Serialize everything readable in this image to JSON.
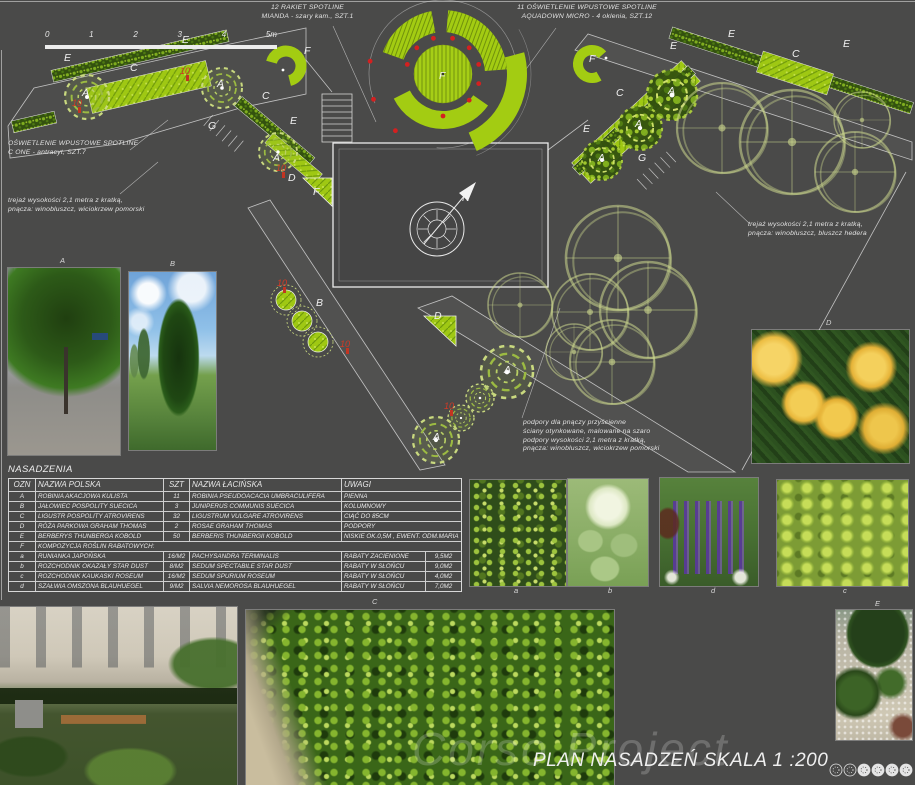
{
  "title_block": {
    "title": "PLAN NASADZEŃ  SKALA 1 :200",
    "watermark": "Corso Project"
  },
  "scale_bar": {
    "ticks": [
      "0",
      "1",
      "2",
      "3",
      "4",
      "5m"
    ]
  },
  "annotations": {
    "spotline_mianda": "12  RAKIET SPOTLINE\nMIANDA - szary kam., SZT.1",
    "aquadown": "11  OŚWIETLENIE WPUSTOWE SPOTLINE\nAQUADOWN MICRO - 4 oklenia, SZT.12",
    "cone": "OŚWIETLENIE WPUSTOWE SPOTLINE\nC ONE - antracyt, SZT.7",
    "trellis_left": "trejaż wysokości 2,1 metra z kratką,\npnącza: winobluszcz, wiciokrzew pomorski",
    "trellis_right": "trejaż wysokości 2,1 metra z kratką,\npnącza: winobluszcz, bluszcz hedera",
    "supports": "podpory dla pnączy przyścienne\nściany otynkowane, malowane na szaro\npodpory wysokości 2,1 metra z kratką,\npnącza: winobluszcz, wiciokrzew pomorski"
  },
  "plan": {
    "north_label": "N",
    "labels": [
      {
        "t": "E",
        "x": 64,
        "y": 61
      },
      {
        "t": "E",
        "x": 182,
        "y": 43
      },
      {
        "t": "C",
        "x": 130,
        "y": 71
      },
      {
        "t": "A",
        "x": 82,
        "y": 96
      },
      {
        "t": "A",
        "x": 217,
        "y": 87
      },
      {
        "t": "G",
        "x": 208,
        "y": 129
      },
      {
        "t": "C",
        "x": 262,
        "y": 99
      },
      {
        "t": "E",
        "x": 290,
        "y": 124
      },
      {
        "t": "A",
        "x": 273,
        "y": 161
      },
      {
        "t": "D",
        "x": 288,
        "y": 181
      },
      {
        "t": "F",
        "x": 313,
        "y": 195
      },
      {
        "t": "F",
        "x": 304,
        "y": 54
      },
      {
        "t": "F",
        "x": 439,
        "y": 79
      },
      {
        "t": "F",
        "x": 589,
        "y": 62
      },
      {
        "t": "E",
        "x": 670,
        "y": 49
      },
      {
        "t": "E",
        "x": 728,
        "y": 37
      },
      {
        "t": "C",
        "x": 792,
        "y": 57
      },
      {
        "t": "E",
        "x": 843,
        "y": 47
      },
      {
        "t": "C",
        "x": 616,
        "y": 96
      },
      {
        "t": "A",
        "x": 668,
        "y": 94
      },
      {
        "t": "A",
        "x": 635,
        "y": 127
      },
      {
        "t": "E",
        "x": 583,
        "y": 132
      },
      {
        "t": "A",
        "x": 598,
        "y": 161
      },
      {
        "t": "G",
        "x": 638,
        "y": 161
      },
      {
        "t": "B",
        "x": 316,
        "y": 306
      },
      {
        "t": "D",
        "x": 434,
        "y": 319
      },
      {
        "t": "A",
        "x": 504,
        "y": 373
      },
      {
        "t": "A",
        "x": 433,
        "y": 440
      },
      {
        "t": "N",
        "x": 462,
        "y": 201
      }
    ],
    "red_labels": [
      {
        "t": "10",
        "x": 72,
        "y": 106
      },
      {
        "t": "10",
        "x": 180,
        "y": 74
      },
      {
        "t": "10",
        "x": 276,
        "y": 171
      },
      {
        "t": "10",
        "x": 277,
        "y": 286
      },
      {
        "t": "10",
        "x": 340,
        "y": 347
      },
      {
        "t": "10",
        "x": 444,
        "y": 409
      }
    ]
  },
  "table": {
    "title": "NASADZENIA",
    "headers": [
      "OZN",
      "NAZWA POLSKA",
      "SZT",
      "NAZWA ŁACIŃSKA",
      "UWAGI"
    ],
    "rows": [
      {
        "ozn": "A",
        "polska": "ROBINIA AKACJOWA KULISTA",
        "szt": "11",
        "lacinska": "ROBINIA PSEUDOACACIA UMBRACULIFERA",
        "uwagi": "PIENNA",
        "area": null
      },
      {
        "ozn": "B",
        "polska": "JAŁOWIEC POSPOLITY SUECICA",
        "szt": "3",
        "lacinska": "JUNIPERUS COMMUNIS SUECICA",
        "uwagi": "KOLUMNOWY",
        "area": null
      },
      {
        "ozn": "C",
        "polska": "LIGUSTR POSPOLITY ATROVIRENS",
        "szt": "32",
        "lacinska": "LIGUSTRUM VULGARE ATROVIRENS",
        "uwagi": "CIĄĆ DO 85CM",
        "area": null
      },
      {
        "ozn": "D",
        "polska": "RÓŻA PARKOWA GRAHAM THOMAS",
        "szt": "2",
        "lacinska": "ROSAE GRAHAM THOMAS",
        "uwagi": "PODPORY",
        "area": null
      },
      {
        "ozn": "E",
        "polska": "BERBERYS THUNBERGA KOBOLD",
        "szt": "50",
        "lacinska": "BERBERIS THUNBERGII KOBOLD",
        "uwagi": "NISKIE OK.0,5M , EWENT. ODM.MARIA",
        "area": null
      },
      {
        "ozn": "F",
        "polska": "KOMPOZYCJA ROŚLIN RABATOWYCH:",
        "szt": "",
        "lacinska": "",
        "uwagi": "",
        "area": null,
        "span": true
      },
      {
        "ozn": "a",
        "polska": "RUNIANKA JAPOŃSKA",
        "szt": "16/M2",
        "lacinska": "PACHYSANDRA TERMINALIS",
        "uwagi": "RABATY ZACIENIONE",
        "area": "9,5M2"
      },
      {
        "ozn": "b",
        "polska": "ROZCHODNIK OKAZAŁY STAR DUST",
        "szt": "8/M2",
        "lacinska": "SEDUM SPECTABILE STAR DUST",
        "uwagi": "RABATY W SŁOŃCU",
        "area": "9,0M2"
      },
      {
        "ozn": "c",
        "polska": "ROZCHODNIK KAUKASKI ROSEUM",
        "szt": "16/M2",
        "lacinska": "SEDUM SPURIUM ROSEUM",
        "uwagi": "RABATY W SŁOŃCU",
        "area": "4,0M2"
      },
      {
        "ozn": "d",
        "polska": "SZAŁWIA OMSZONA BLAUHUEGEL",
        "szt": "9/M2",
        "lacinska": "SALVIA NEMOROSA BLAUHUEGEL",
        "uwagi": "RABATY W SŁOŃCU",
        "area": "7,0M2"
      }
    ]
  },
  "photos": {
    "label_a_tree": "A",
    "label_b_tree": "B",
    "label_d_rose": "D",
    "label_pachysandra": "a",
    "label_sedum_spectabile": "b",
    "label_salvia": "d",
    "label_sedum_spurium": "c",
    "label_hedge": "C",
    "label_berberis": "E"
  }
}
